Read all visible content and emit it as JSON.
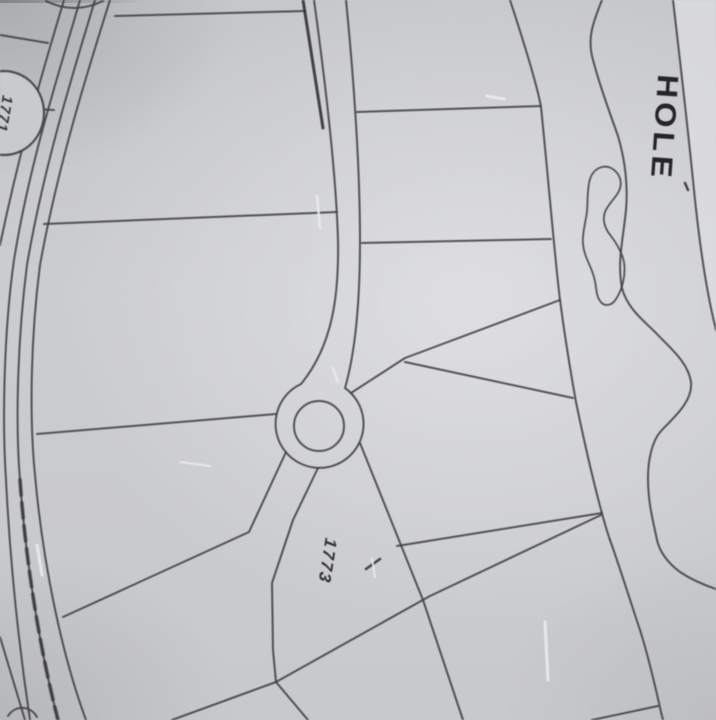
{
  "meta": {
    "title": "Subdivision plat map photograph with golf hole"
  },
  "labels": {
    "hole": "HOLE",
    "lot_main": "1773",
    "lot_circle": "1771"
  },
  "colors": {
    "paper": "#cbccce",
    "paper_light": "#e0e0e2",
    "paper_shadow": "#97989c",
    "ink": "#3e3e43",
    "ink_heavy": "#26262a",
    "scratch_white": "#eceded"
  }
}
